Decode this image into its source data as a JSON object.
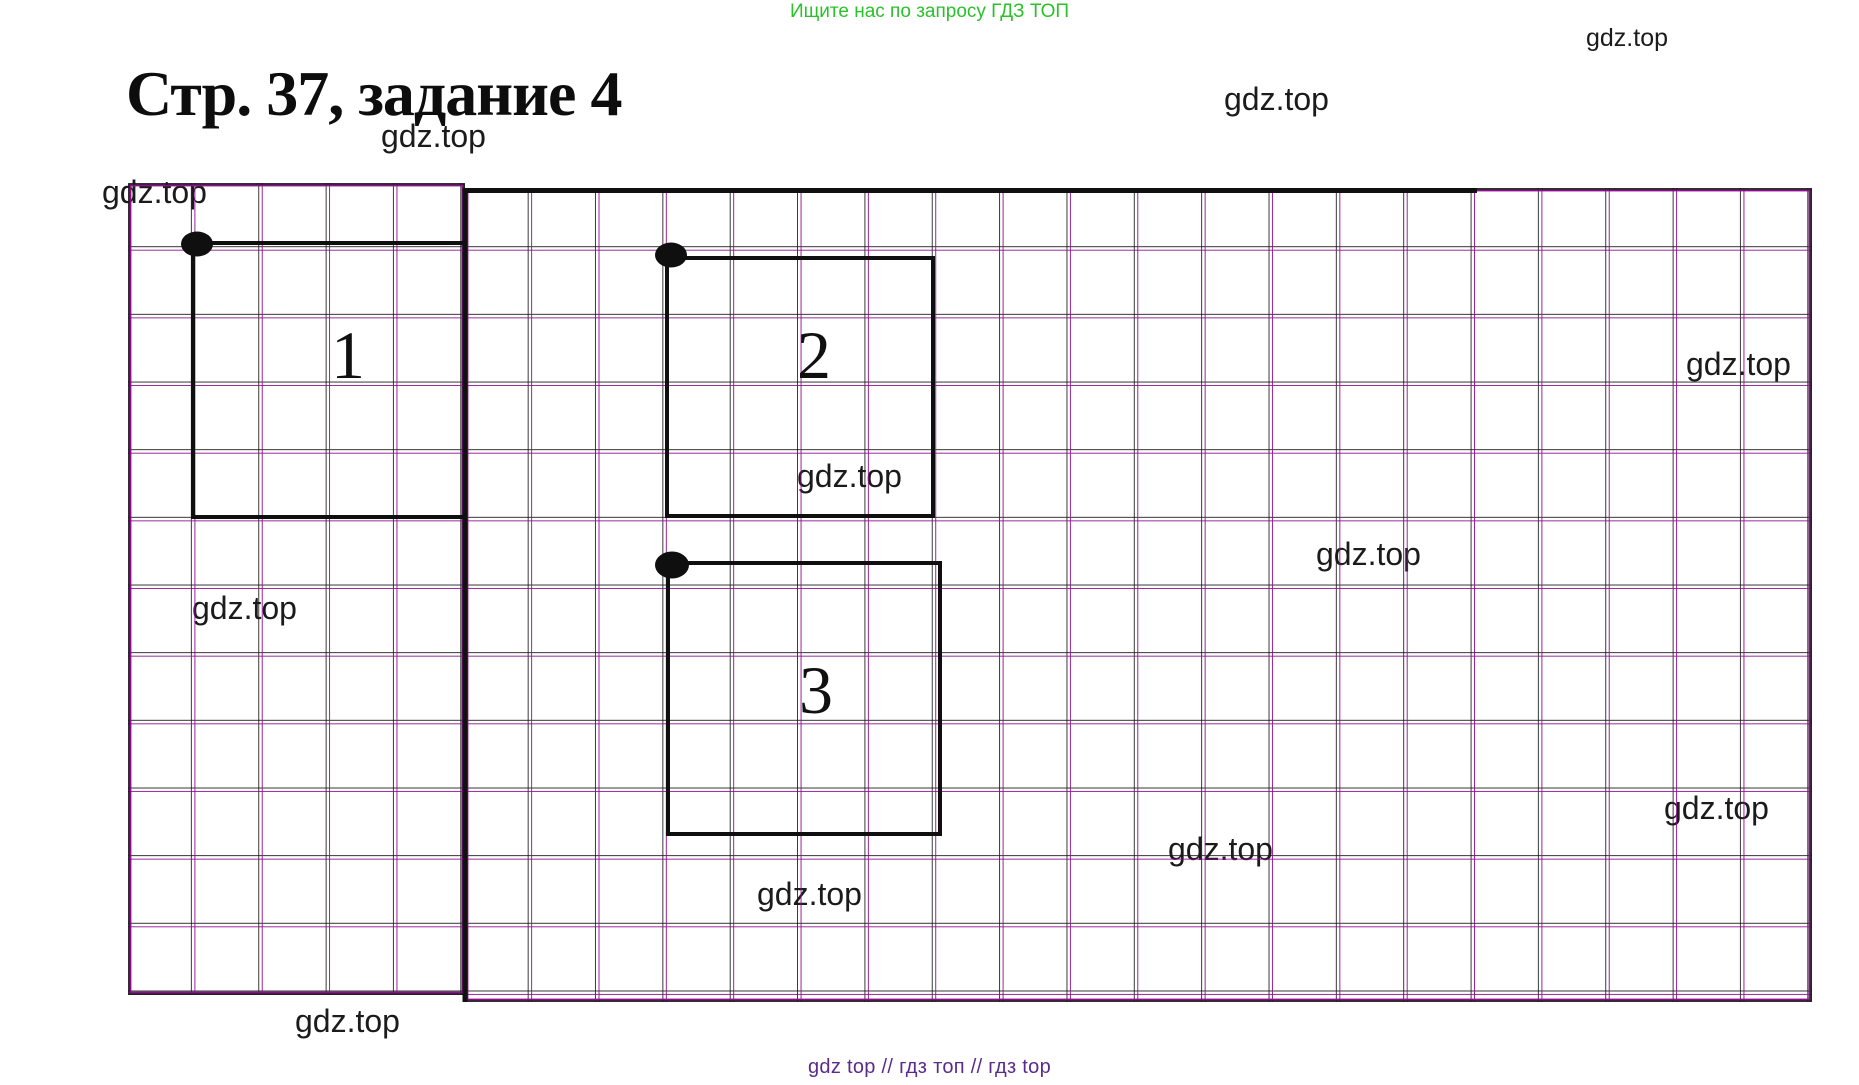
{
  "banner": {
    "text": "Ищите нас по запросу ГДЗ ТОП",
    "color": "#2bc12b"
  },
  "title": {
    "text": "Стр. 37, задание 4"
  },
  "watermark": {
    "text": "gdz.top"
  },
  "footer": {
    "text": "gdz top // гдз топ // гдз top",
    "color": "#5b2b8b"
  },
  "figure": {
    "grid_line_color": "#8e0d8e",
    "grid_secondary_line_color": "#191919",
    "ink_color": "#101010",
    "squares": [
      {
        "label": "1"
      },
      {
        "label": "2"
      },
      {
        "label": "3"
      }
    ]
  }
}
